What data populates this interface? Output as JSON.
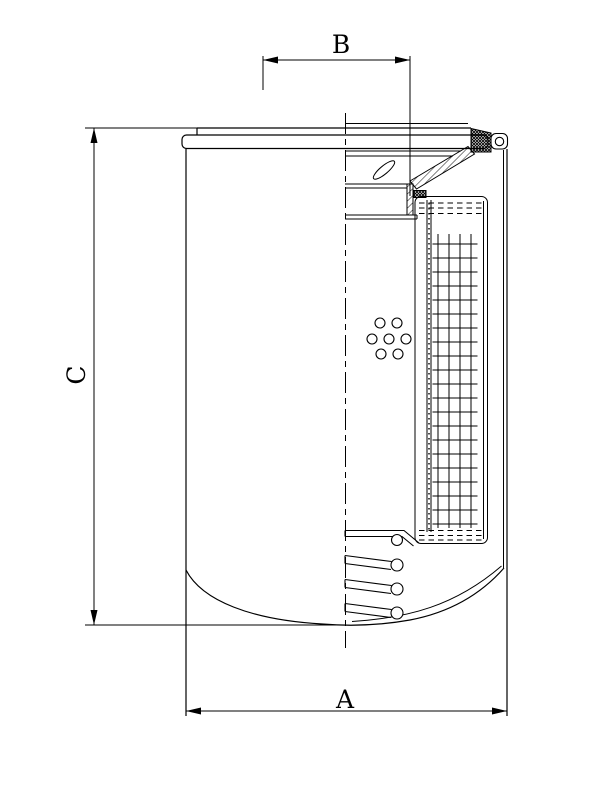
{
  "page": {
    "background_color": "#ffffff",
    "stroke_color": "#000000"
  },
  "drawing": {
    "kind": "technical-section-drawing",
    "subject": "spin-on filter cartridge cross-section",
    "dim_top": {
      "label": "B",
      "orientation": "horizontal",
      "position": "top"
    },
    "dim_left": {
      "label": "C",
      "orientation": "vertical",
      "position": "left"
    },
    "dim_bottom": {
      "label": "A",
      "orientation": "horizontal",
      "position": "bottom"
    }
  }
}
